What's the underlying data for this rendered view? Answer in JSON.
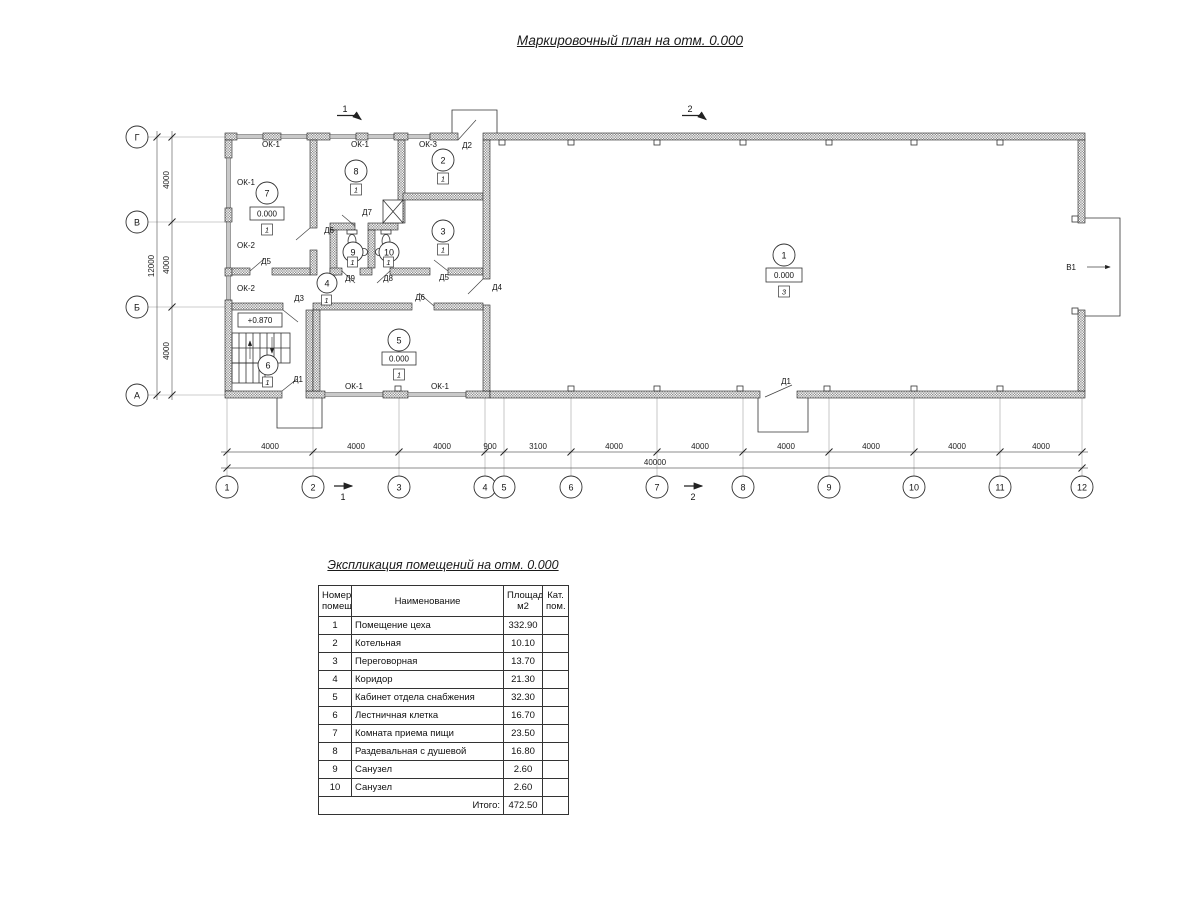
{
  "plan": {
    "title": "Маркировочный план на отм. 0.000",
    "axes_bottom": [
      "1",
      "2",
      "3",
      "4",
      "5",
      "6",
      "7",
      "8",
      "9",
      "10",
      "11",
      "12"
    ],
    "axes_left": [
      "Г",
      "В",
      "Б",
      "А"
    ],
    "dims_bottom": [
      "4000",
      "4000",
      "4000",
      "900",
      "3100",
      "4000",
      "4000",
      "4000",
      "4000",
      "4000",
      "4000"
    ],
    "total_bottom": "40000",
    "dims_left": [
      "4000",
      "4000",
      "4000"
    ],
    "total_left": "12000",
    "section1": "1",
    "section2": "2",
    "gate_label": "В1",
    "elev_zero": "0.000",
    "elev_stair": "+0.870",
    "windows": {
      "ok1": "ОК-1",
      "ok2": "ОК-2",
      "ok3": "ОК-3"
    },
    "doors": {
      "d1": "Д1",
      "d2": "Д2",
      "d3": "Д3",
      "d4": "Д4",
      "d5": "Д5",
      "d6": "Д6",
      "d7": "Д7",
      "d8": "Д8",
      "d9": "Д9"
    },
    "rooms": {
      "r1": {
        "num": "1",
        "cat": "3"
      },
      "r2": {
        "num": "2",
        "cat": "1"
      },
      "r3": {
        "num": "3",
        "cat": "1"
      },
      "r4": {
        "num": "4",
        "cat": "1"
      },
      "r5": {
        "num": "5",
        "cat": "1"
      },
      "r6": {
        "num": "6",
        "cat": "1"
      },
      "r7": {
        "num": "7",
        "cat": "1"
      },
      "r8": {
        "num": "8",
        "cat": "1"
      },
      "r9": {
        "num": "9",
        "cat": "1"
      },
      "r10": {
        "num": "10",
        "cat": "1"
      }
    }
  },
  "table": {
    "title": "Экспликация помещений на отм. 0.000",
    "headers": {
      "num": "Номер\nпомещ.",
      "name": "Наименование",
      "area": "Площадь,\nм2",
      "cat": "Кат.\nпом."
    },
    "rows": [
      [
        "1",
        "Помещение цеха",
        "332.90"
      ],
      [
        "2",
        "Котельная",
        "10.10"
      ],
      [
        "3",
        "Переговорная",
        "13.70"
      ],
      [
        "4",
        "Коридор",
        "21.30"
      ],
      [
        "5",
        "Кабинет отдела снабжения",
        "32.30"
      ],
      [
        "6",
        "Лестничная клетка",
        "16.70"
      ],
      [
        "7",
        "Комната приема пищи",
        "23.50"
      ],
      [
        "8",
        "Раздевальная с душевой",
        "16.80"
      ],
      [
        "9",
        "Санузел",
        "2.60"
      ],
      [
        "10",
        "Санузел",
        "2.60"
      ]
    ],
    "total_label": "Итого:",
    "total_value": "472.50"
  }
}
